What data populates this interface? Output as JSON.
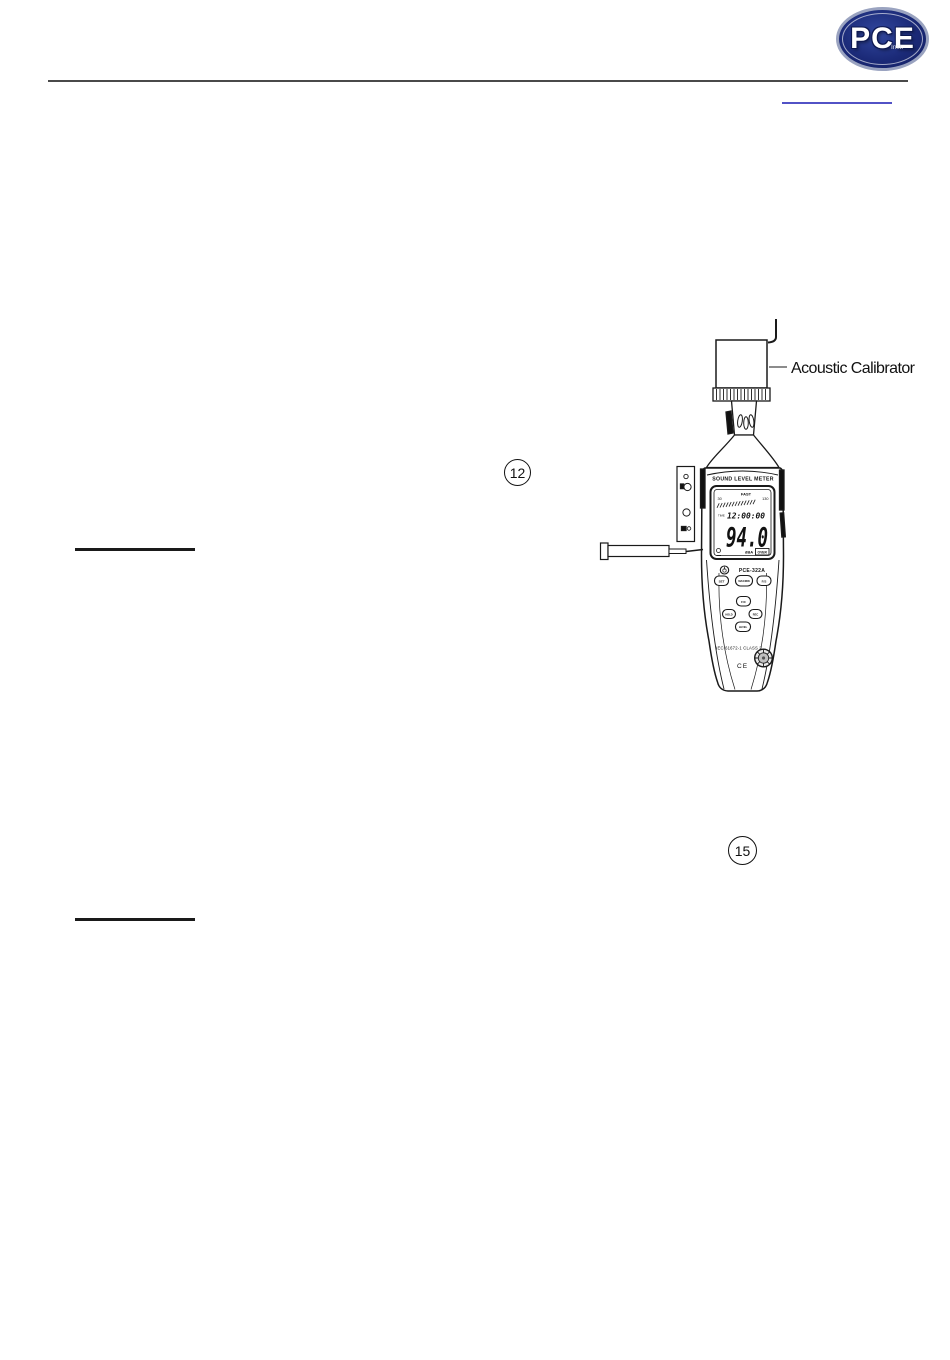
{
  "header": {
    "logo": {
      "text": "PCE",
      "subtext": "Inst.",
      "bg_color": "#1b2a78",
      "ring_color": "#9aa3c0"
    },
    "rule_color": "#4a4a4a",
    "link_underline_color": "#5252c6"
  },
  "dividers": {
    "color": "#1a1a1a"
  },
  "callouts": {
    "twelve": "12",
    "fifteen": "15"
  },
  "figure": {
    "calibrator_label": "Acoustic Calibrator",
    "meter": {
      "title": "SOUND LEVEL METER",
      "model": "PCE-322A",
      "display": {
        "response": "FAST",
        "scale_min": "30",
        "scale_max": "130",
        "time_label": "TIME",
        "time_value": "12:00:00",
        "value": "94.0",
        "unit": "dBA",
        "flag": "OVER"
      },
      "buttons": {
        "set": "SET",
        "max_min": "MAX/MIN",
        "fast_slow": "F/S",
        "freq_weight": "F/C",
        "hold": "HOLD",
        "rec": "REC",
        "level": "LEVEL"
      },
      "compliance": "IEC 61672-1 CLASS 2",
      "ce_mark": "CE"
    }
  }
}
